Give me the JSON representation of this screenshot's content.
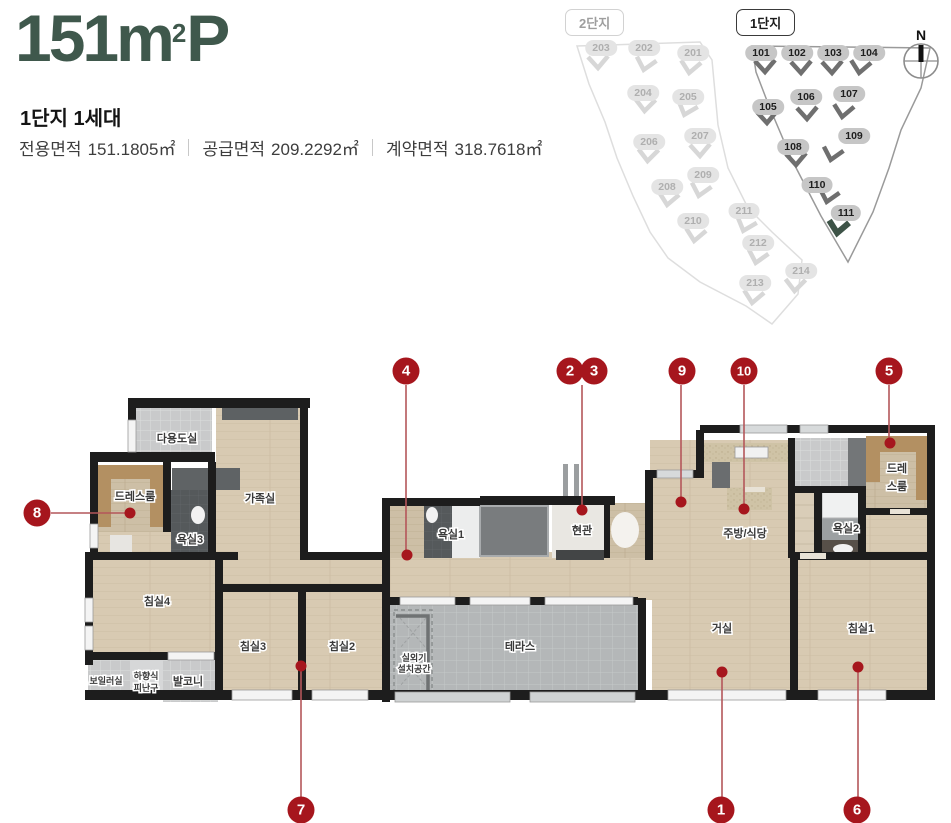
{
  "header": {
    "title": {
      "base": "151m",
      "sup": "2",
      "suffix": "P"
    },
    "subtitle": "1단지 1세대",
    "areas": [
      {
        "label": "전용면적",
        "value": "151.1805㎡"
      },
      {
        "label": "공급면적",
        "value": "209.2292㎡"
      },
      {
        "label": "계약면적",
        "value": "318.7618㎡"
      }
    ]
  },
  "sitemap": {
    "compass": "N",
    "complex2": {
      "tag": "2단지",
      "buildings": [
        "203",
        "202",
        "201",
        "204",
        "205",
        "206",
        "207",
        "208",
        "209",
        "210",
        "211",
        "212",
        "213",
        "214"
      ]
    },
    "complex1": {
      "tag": "1단지",
      "highlighted": "111",
      "buildings": [
        "101",
        "102",
        "103",
        "104",
        "105",
        "106",
        "107",
        "108",
        "109",
        "110",
        "111"
      ]
    }
  },
  "floorplan": {
    "rooms": {
      "utility": "다용도실",
      "dress_left": "드레스룸",
      "family": "가족실",
      "bath3": "욕실3",
      "bed4": "침실4",
      "bed3": "침실3",
      "bed2": "침실2",
      "boiler": "보일러실",
      "escape1": "하향식",
      "escape2": "피난구",
      "balcony": "발코니",
      "bath1": "욕실1",
      "entrance": "현관",
      "terrace": "테라스",
      "outdoor1": "실외기",
      "outdoor2": "설치공간",
      "kitchen": "주방/식당",
      "bath2": "욕실2",
      "dress_right1": "드레",
      "dress_right2": "스룸",
      "living": "거실",
      "bed1": "침실1"
    },
    "markers": [
      "1",
      "2",
      "3",
      "4",
      "5",
      "6",
      "7",
      "8",
      "9",
      "10"
    ]
  },
  "colors": {
    "accent_green": "#3f584c",
    "marker_red": "#a6161d",
    "wall_black": "#1d1d1d",
    "wood": "#d8cab2"
  }
}
